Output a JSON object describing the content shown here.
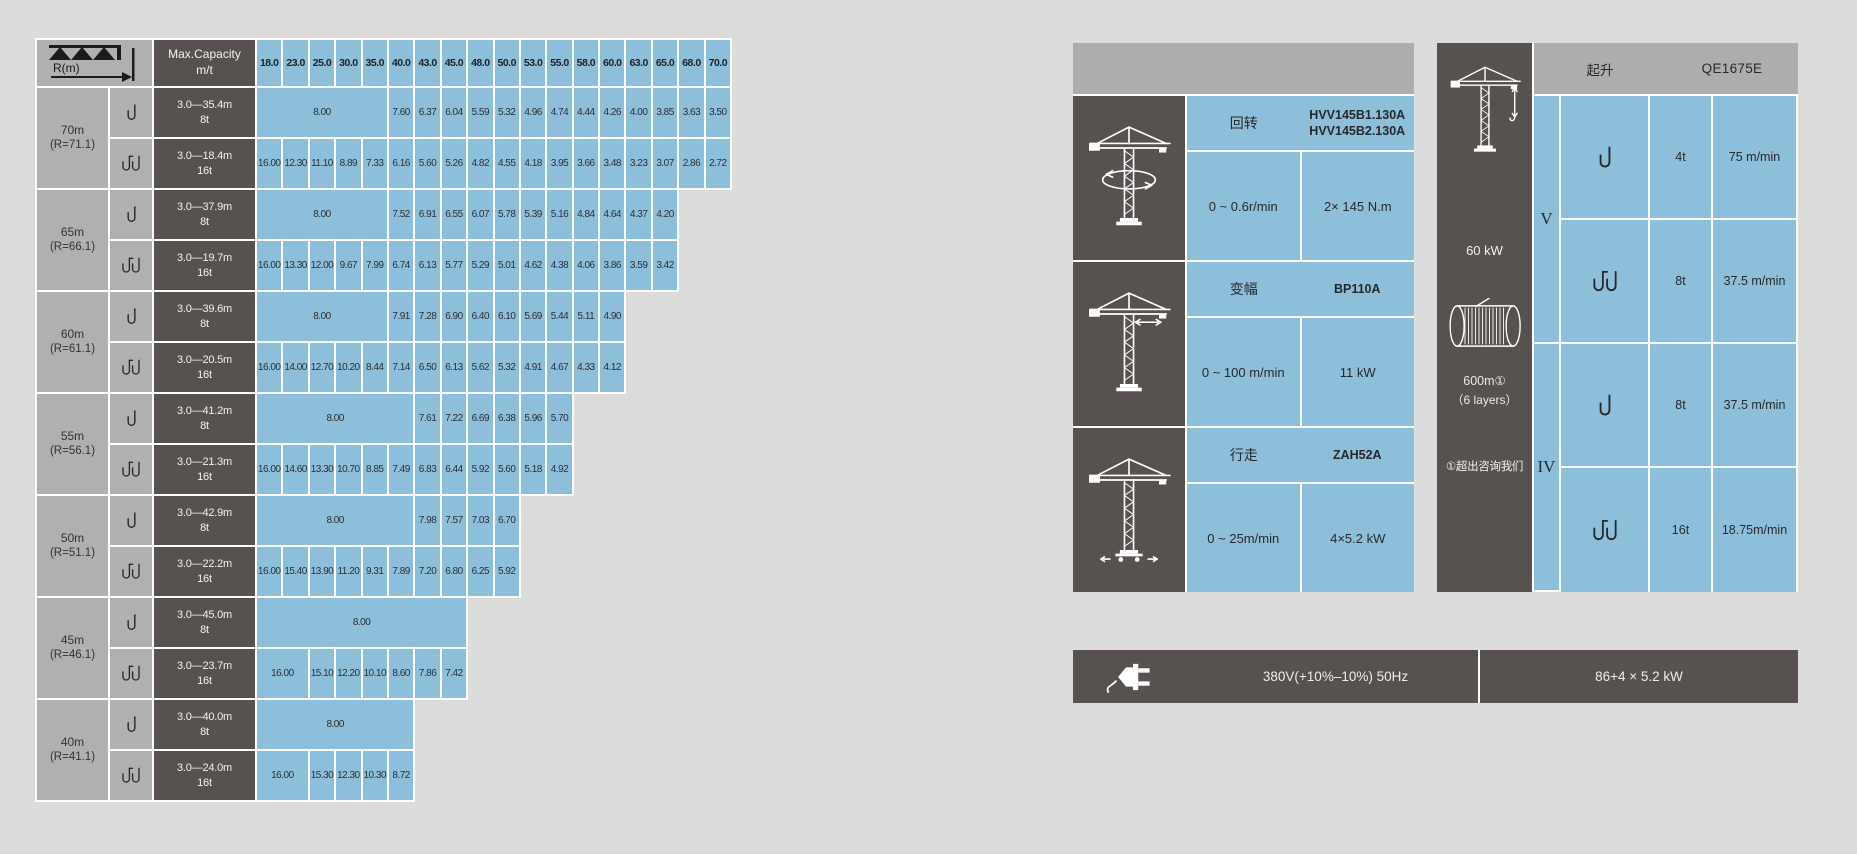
{
  "colors": {
    "page_bg": "#dcdcdc",
    "cell_blue": "#8ebfda",
    "cell_dark": "#575150",
    "cell_gray": "#b1b0b0",
    "header_gray": "#adadab",
    "grid_line": "#ffffff"
  },
  "load_chart": {
    "corner": {
      "label": "R(m)"
    },
    "capacity_header": {
      "line1": "Max.Capacity",
      "line2": "m/t"
    },
    "radius_columns": [
      "18.0",
      "23.0",
      "25.0",
      "30.0",
      "35.0",
      "40.0",
      "43.0",
      "45.0",
      "48.0",
      "50.0",
      "53.0",
      "55.0",
      "58.0",
      "60.0",
      "63.0",
      "65.0",
      "68.0",
      "70.0"
    ],
    "groups": [
      {
        "jib": "70m",
        "radius": "(R=71.1)",
        "rows": [
          {
            "hook": "single",
            "range": "3.0—35.4m",
            "capacity": "8t",
            "lead_span": 5,
            "lead_value": "8.00",
            "values": [
              "7.60",
              "6.37",
              "6.04",
              "5.59",
              "5.32",
              "4.96",
              "4.74",
              "4.44",
              "4.26",
              "4.00",
              "3.85",
              "3.63",
              "3.50"
            ]
          },
          {
            "hook": "double",
            "range": "3.0—18.4m",
            "capacity": "16t",
            "lead_span": 0,
            "lead_value": "",
            "values": [
              "16.00",
              "12.30",
              "11.10",
              "8.89",
              "7.33",
              "6.16",
              "5.60",
              "5.26",
              "4.82",
              "4.55",
              "4.18",
              "3.95",
              "3.66",
              "3.48",
              "3.23",
              "3.07",
              "2.86",
              "2.72"
            ]
          }
        ]
      },
      {
        "jib": "65m",
        "radius": "(R=66.1)",
        "rows": [
          {
            "hook": "single",
            "range": "3.0—37.9m",
            "capacity": "8t",
            "lead_span": 5,
            "lead_value": "8.00",
            "values": [
              "7.52",
              "6.91",
              "6.55",
              "6.07",
              "5.78",
              "5.39",
              "5.16",
              "4.84",
              "4.64",
              "4.37",
              "4.20"
            ]
          },
          {
            "hook": "double",
            "range": "3.0—19.7m",
            "capacity": "16t",
            "lead_span": 0,
            "lead_value": "",
            "values": [
              "16.00",
              "13.30",
              "12.00",
              "9.67",
              "7.99",
              "6.74",
              "6.13",
              "5.77",
              "5.29",
              "5.01",
              "4.62",
              "4.38",
              "4.06",
              "3.86",
              "3.59",
              "3.42"
            ]
          }
        ]
      },
      {
        "jib": "60m",
        "radius": "(R=61.1)",
        "rows": [
          {
            "hook": "single",
            "range": "3.0—39.6m",
            "capacity": "8t",
            "lead_span": 5,
            "lead_value": "8.00",
            "values": [
              "7.91",
              "7.28",
              "6.90",
              "6.40",
              "6.10",
              "5.69",
              "5.44",
              "5.11",
              "4.90"
            ]
          },
          {
            "hook": "double",
            "range": "3.0—20.5m",
            "capacity": "16t",
            "lead_span": 0,
            "lead_value": "",
            "values": [
              "16.00",
              "14.00",
              "12.70",
              "10.20",
              "8.44",
              "7.14",
              "6.50",
              "6.13",
              "5.62",
              "5.32",
              "4.91",
              "4.67",
              "4.33",
              "4.12"
            ]
          }
        ]
      },
      {
        "jib": "55m",
        "radius": "(R=56.1)",
        "rows": [
          {
            "hook": "single",
            "range": "3.0—41.2m",
            "capacity": "8t",
            "lead_span": 6,
            "lead_value": "8.00",
            "values": [
              "7.61",
              "7.22",
              "6.69",
              "6.38",
              "5.96",
              "5.70"
            ]
          },
          {
            "hook": "double",
            "range": "3.0—21.3m",
            "capacity": "16t",
            "lead_span": 0,
            "lead_value": "",
            "values": [
              "16.00",
              "14.60",
              "13.30",
              "10.70",
              "8.85",
              "7.49",
              "6.83",
              "6.44",
              "5.92",
              "5.60",
              "5.18",
              "4.92"
            ]
          }
        ]
      },
      {
        "jib": "50m",
        "radius": "(R=51.1)",
        "rows": [
          {
            "hook": "single",
            "range": "3.0—42.9m",
            "capacity": "8t",
            "lead_span": 6,
            "lead_value": "8.00",
            "values": [
              "7.98",
              "7.57",
              "7.03",
              "6.70"
            ]
          },
          {
            "hook": "double",
            "range": "3.0—22.2m",
            "capacity": "16t",
            "lead_span": 0,
            "lead_value": "",
            "values": [
              "16.00",
              "15.40",
              "13.90",
              "11.20",
              "9.31",
              "7.89",
              "7.20",
              "6.80",
              "6.25",
              "5.92"
            ]
          }
        ]
      },
      {
        "jib": "45m",
        "radius": "(R=46.1)",
        "rows": [
          {
            "hook": "single",
            "range": "3.0—45.0m",
            "capacity": "8t",
            "lead_span": 8,
            "lead_value": "8.00",
            "values": []
          },
          {
            "hook": "double",
            "range": "3.0—23.7m",
            "capacity": "16t",
            "lead_span": 2,
            "lead_value": "16.00",
            "values": [
              "15.10",
              "12.20",
              "10.10",
              "8.60",
              "7.86",
              "7.42"
            ]
          }
        ]
      },
      {
        "jib": "40m",
        "radius": "(R=41.1)",
        "rows": [
          {
            "hook": "single",
            "range": "3.0—40.0m",
            "capacity": "8t",
            "lead_span": 6,
            "lead_value": "8.00",
            "values": []
          },
          {
            "hook": "double",
            "range": "3.0—24.0m",
            "capacity": "16t",
            "lead_span": 2,
            "lead_value": "16.00",
            "values": [
              "15.30",
              "12.30",
              "10.30",
              "8.72"
            ]
          }
        ]
      }
    ]
  },
  "mechanism_panel": {
    "sections": [
      {
        "icon": "slewing",
        "name": "回转",
        "model_lines": [
          "HVV145B1.130A",
          "HVV145B2.130A"
        ],
        "speed": "0 ~ 0.6r/min",
        "power": "2× 145 N.m"
      },
      {
        "icon": "trolley",
        "name": "变幅",
        "model_lines": [
          "BP110A"
        ],
        "speed": "0 ~ 100 m/min",
        "power": "11 kW"
      },
      {
        "icon": "travel",
        "name": "行走",
        "model_lines": [
          "ZAH52A"
        ],
        "speed": "0 ~ 25m/min",
        "power": "4×5.2 kW"
      }
    ]
  },
  "hoist_panel": {
    "title": "起升",
    "model": "QE1675E",
    "motor_power": "60 kW",
    "rope_length": "600m①",
    "rope_layers": "（6 layers）",
    "note": "①超出咨询我们",
    "groups": [
      {
        "gear": "V",
        "rows": [
          {
            "hook": "single",
            "load": "4t",
            "speed": "75 m/min"
          },
          {
            "hook": "double",
            "load": "8t",
            "speed": "37.5 m/min"
          }
        ]
      },
      {
        "gear": "IV",
        "rows": [
          {
            "hook": "single",
            "load": "8t",
            "speed": "37.5 m/min"
          },
          {
            "hook": "double",
            "load": "16t",
            "speed": "18.75m/min"
          }
        ]
      }
    ]
  },
  "power_bar": {
    "voltage": "380V(+10%–10%) 50Hz",
    "total_power": "86+4 × 5.2 kW"
  }
}
